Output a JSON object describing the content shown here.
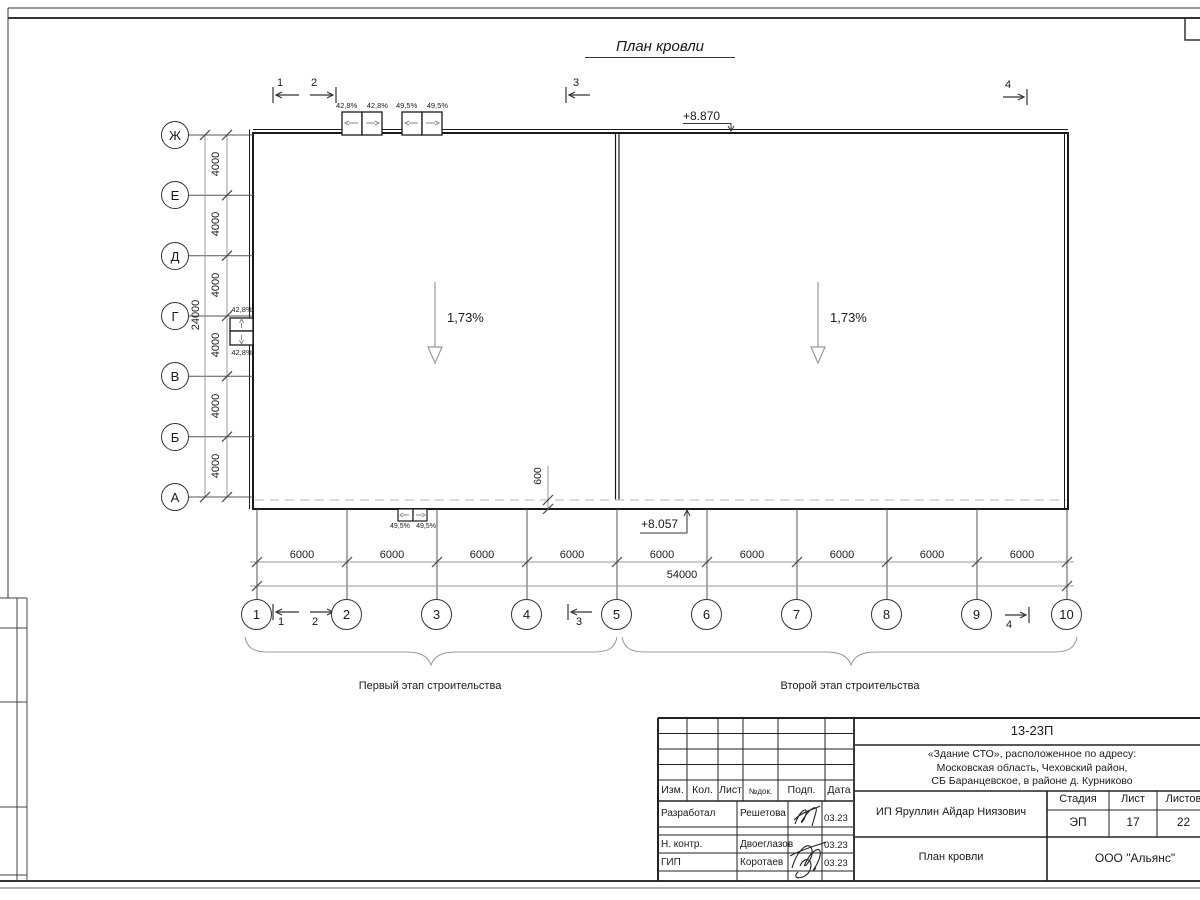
{
  "sheet": {
    "title": "План кровли"
  },
  "roof": {
    "slope_left": "1,73%",
    "slope_right": "1,73%",
    "elev_top": "+8.870",
    "elev_bottom": "+8.057",
    "overhang_dim": "600",
    "top_units_a": [
      "42,8%",
      "42,8%"
    ],
    "top_units_b": [
      "49,5%",
      "49,5%"
    ],
    "left_units": [
      "42,8%",
      "42,8%"
    ],
    "bottom_units": [
      "49,5%",
      "49,5%"
    ]
  },
  "axes": {
    "rows": [
      "Ж",
      "Е",
      "Д",
      "Г",
      "В",
      "Б",
      "А"
    ],
    "cols": [
      "1",
      "2",
      "3",
      "4",
      "5",
      "6",
      "7",
      "8",
      "9",
      "10"
    ],
    "row_dims": [
      "4000",
      "4000",
      "4000",
      "4000",
      "4000",
      "4000"
    ],
    "row_total": "24000",
    "col_dims": [
      "6000",
      "6000",
      "6000",
      "6000",
      "6000",
      "6000",
      "6000",
      "6000",
      "6000"
    ],
    "col_total": "54000"
  },
  "sections": [
    "1",
    "2",
    "3",
    "4"
  ],
  "stages": [
    "Первый этап строительства",
    "Второй этап строительства"
  ],
  "titleblock": {
    "doc_number": "13-23П",
    "project_lines": [
      "«Здание СТО», расположенное по адресу:",
      "Московская область, Чеховский район,",
      "СБ Баранцевское, в районе д. Курниково"
    ],
    "header": {
      "izm": "Изм.",
      "kol": "Кол.",
      "list": "Лист",
      "ndok": "№док.",
      "podp": "Подп.",
      "data": "Дата"
    },
    "rows": [
      {
        "role": "Разработал",
        "name": "Решетова",
        "date": "03.23"
      },
      {
        "role": "Н. контр.",
        "name": "Двоеглазов",
        "date": "03.23"
      },
      {
        "role": "ГИП",
        "name": "Коротаев",
        "date": "03.23"
      }
    ],
    "client": "ИП Яруллин Айдар Ниязович",
    "sheet_title": "План кровли",
    "stage_label": "Стадия",
    "stage": "ЭП",
    "sheet_label": "Лист",
    "sheet": "17",
    "sheets_label": "Листов",
    "sheets": "22",
    "company": "ООО \"Альянс\""
  }
}
